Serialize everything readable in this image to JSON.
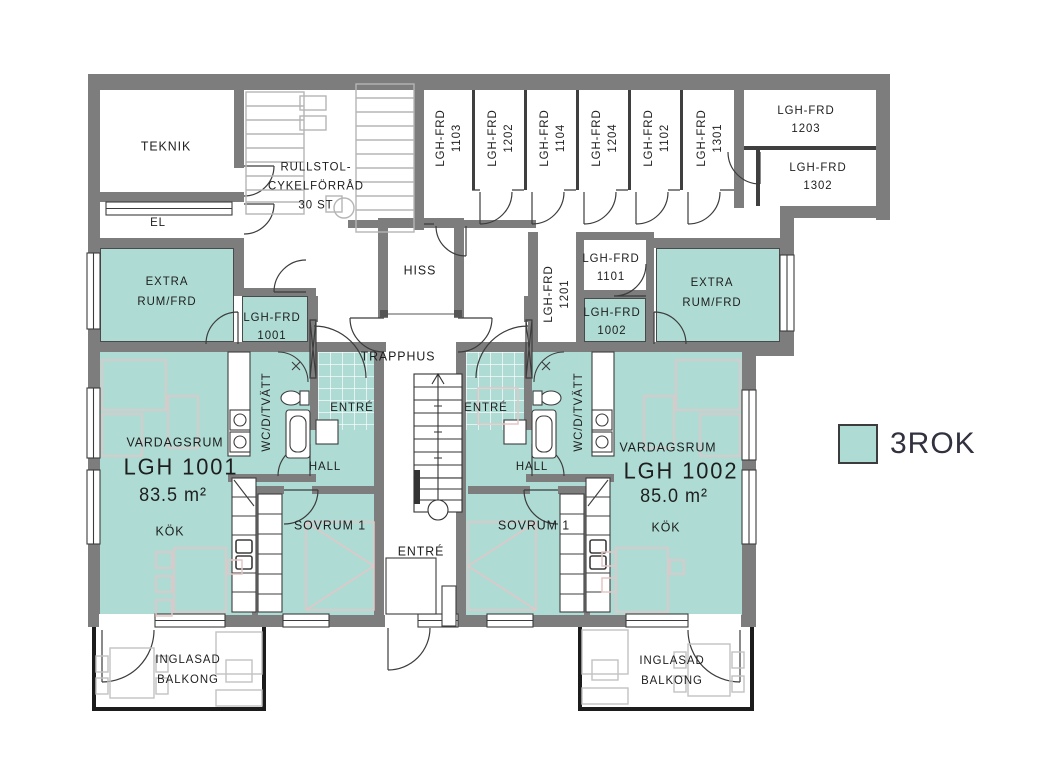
{
  "colors": {
    "room_fill": "#aedbd4",
    "wall": "#7d7d7d",
    "linework": "#3c3c3c",
    "furniture_outline": "#e4c6c6",
    "equipment_outline": "#b5b5b5"
  },
  "legend": {
    "swatch_color": "#aedbd4",
    "label": "3ROK"
  },
  "utility_rooms": {
    "teknik": "TEKNIK",
    "el": "EL",
    "bike_storage_line1": "RULLSTOL-",
    "bike_storage_line2": "CYKELFÖRRÅD",
    "bike_storage_line3": "30 ST",
    "hiss": "HISS",
    "trapphus": "TRAPPHUS",
    "entre_common": "ENTRÉ"
  },
  "extra_rooms": {
    "left_line1": "EXTRA",
    "left_line2": "RUM/FRD",
    "right_line1": "EXTRA",
    "right_line2": "RUM/FRD"
  },
  "storage_top_row": [
    {
      "name": "LGH-FRD",
      "number": "1103"
    },
    {
      "name": "LGH-FRD",
      "number": "1202"
    },
    {
      "name": "LGH-FRD",
      "number": "1104"
    },
    {
      "name": "LGH-FRD",
      "number": "1204"
    },
    {
      "name": "LGH-FRD",
      "number": "1102"
    },
    {
      "name": "LGH-FRD",
      "number": "1301"
    }
  ],
  "storage_corner": [
    {
      "name": "LGH-FRD",
      "number": "1203"
    },
    {
      "name": "LGH-FRD",
      "number": "1302"
    }
  ],
  "storage_core": [
    {
      "name": "LGH-FRD",
      "number": "1201"
    },
    {
      "name": "LGH-FRD",
      "number": "1101"
    },
    {
      "name": "LGH-FRD",
      "number": "1002"
    },
    {
      "name": "LGH-FRD",
      "number": "1001"
    }
  ],
  "apartments": [
    {
      "id": "LGH 1001",
      "area": "83.5 m²",
      "livingroom": "VARDAGSRUM",
      "kitchen": "KÖK",
      "hall": "HALL",
      "bedroom": "SOVRUM 1",
      "entry": "ENTRÉ",
      "bathroom": "WC/D/TVÄTT",
      "balcony_line1": "INGLASAD",
      "balcony_line2": "BALKONG"
    },
    {
      "id": "LGH 1002",
      "area": "85.0 m²",
      "livingroom": "VARDAGSRUM",
      "kitchen": "KÖK",
      "hall": "HALL",
      "bedroom": "SOVRUM 1",
      "entry": "ENTRÉ",
      "bathroom": "WC/D/TVÄTT",
      "balcony_line1": "INGLASAD",
      "balcony_line2": "BALKONG"
    }
  ]
}
